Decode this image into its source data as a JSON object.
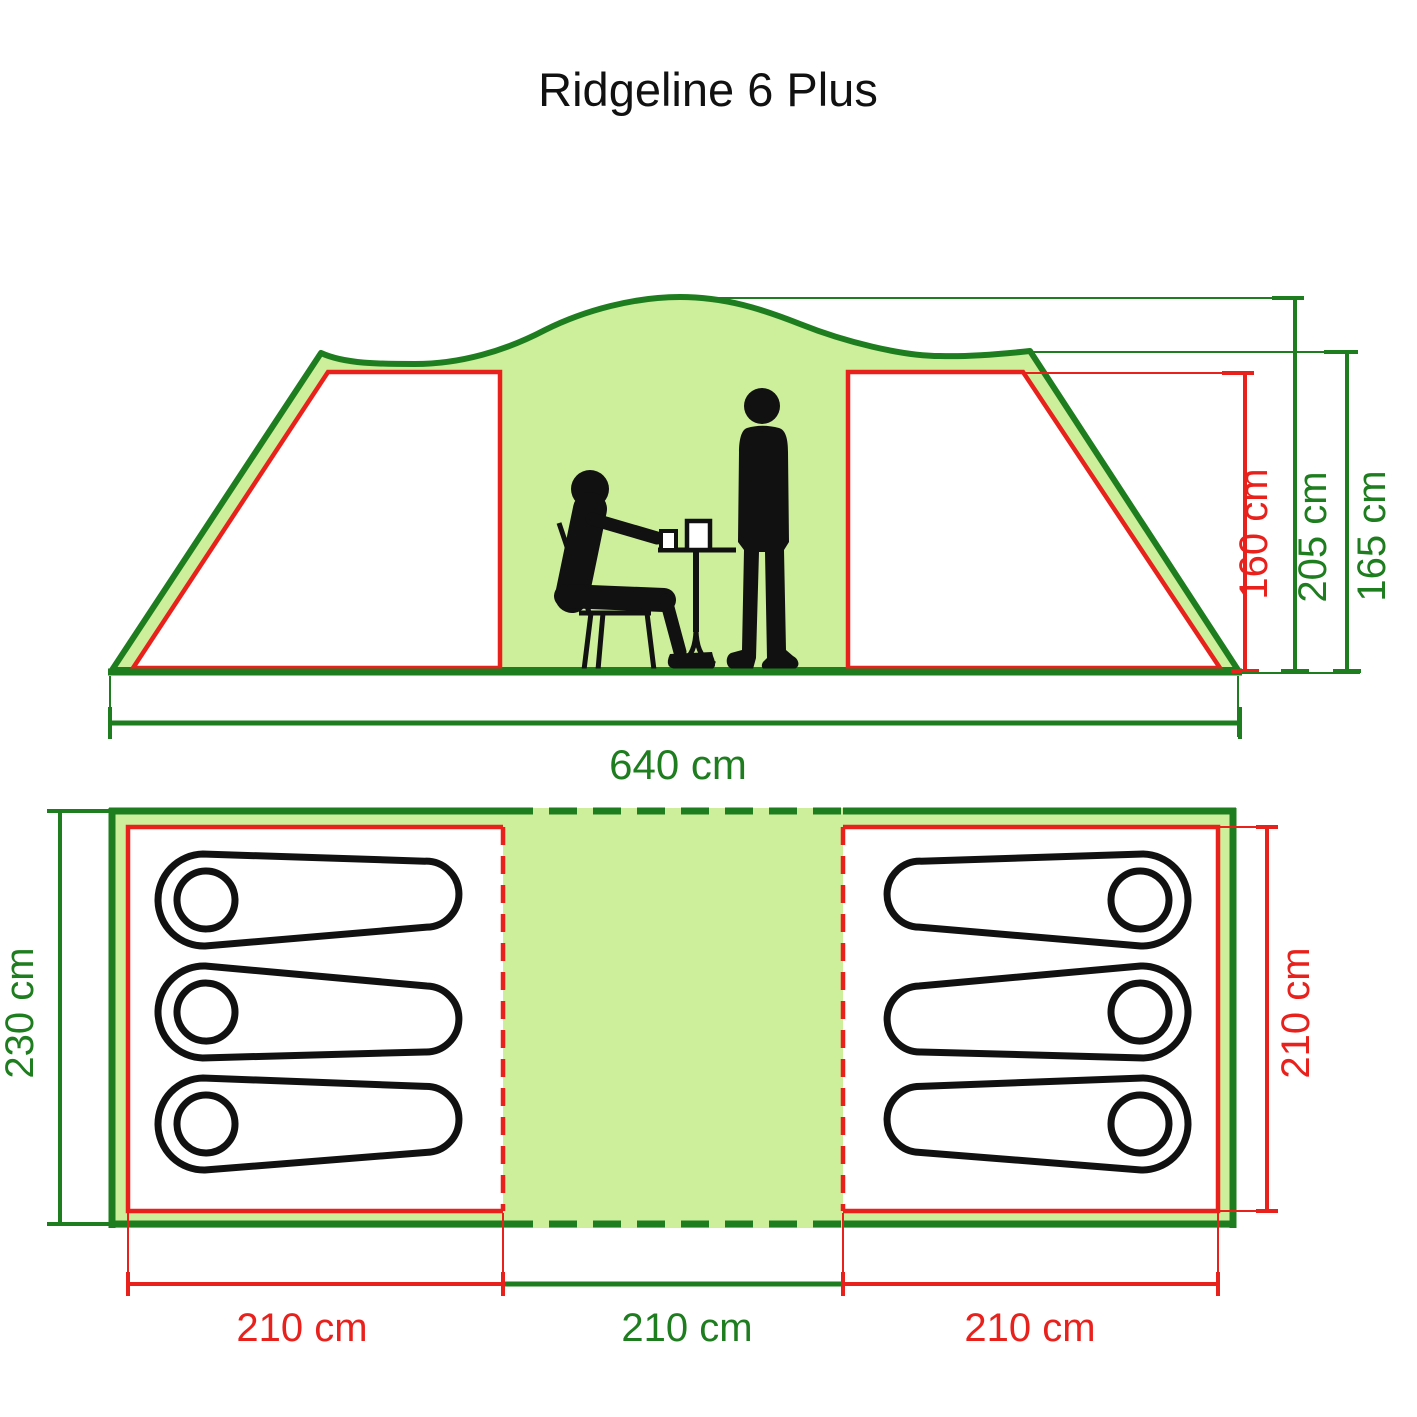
{
  "title": "Ridgeline 6 Plus",
  "colors": {
    "line_green": "#1e7d1e",
    "fill_green": "#cdee9b",
    "red": "#e9211c",
    "black": "#111111",
    "white": "#ffffff"
  },
  "elevation_view": {
    "dimensions": {
      "total_width": "640 cm",
      "inner_height": "160 cm",
      "peak_height": "205 cm",
      "side_height": "165 cm"
    }
  },
  "floor_plan": {
    "dimensions": {
      "total_depth": "230 cm",
      "bedroom_depth": "210 cm",
      "left_bedroom_width": "210 cm",
      "living_area_width": "210 cm",
      "right_bedroom_width": "210 cm"
    },
    "left_bedroom_sleepers": 3,
    "right_bedroom_sleepers": 3
  }
}
